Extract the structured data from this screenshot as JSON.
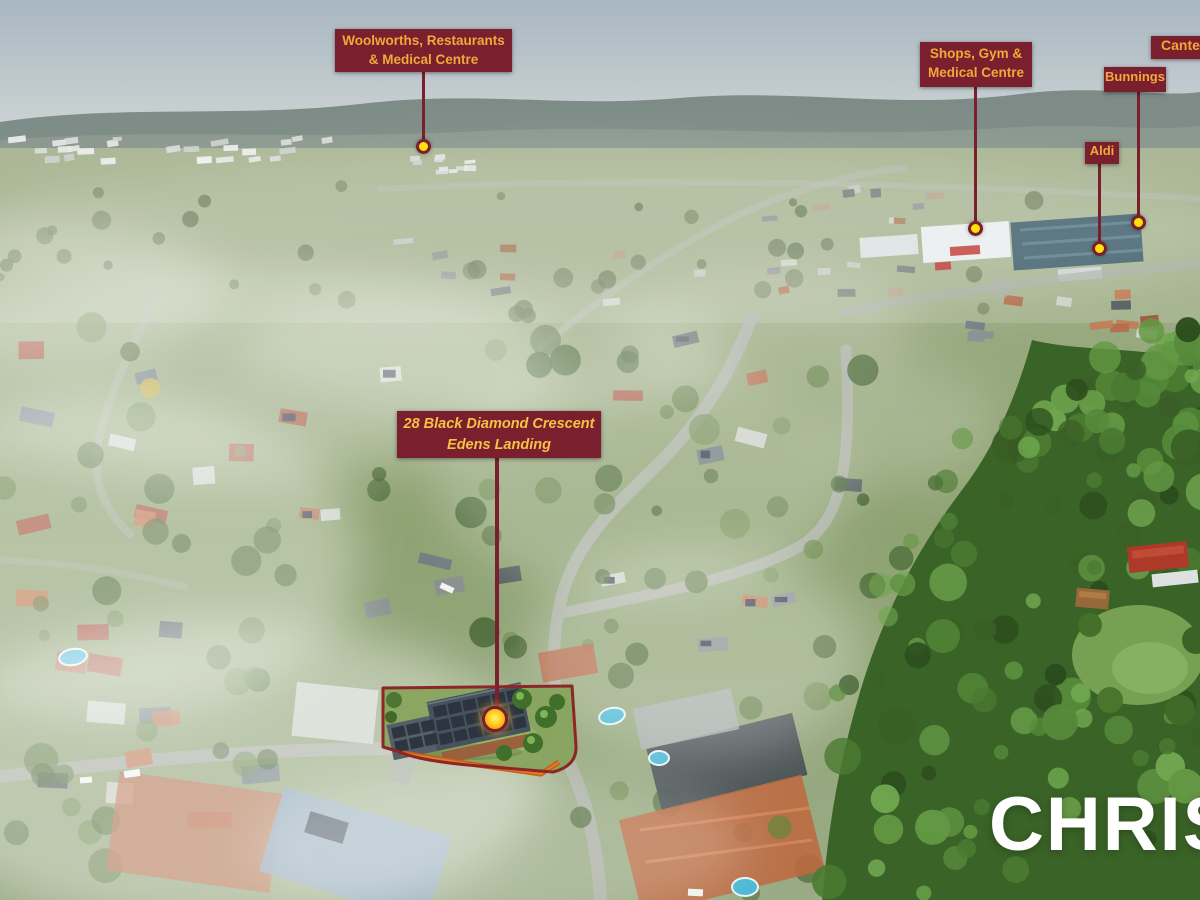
{
  "scene": {
    "description": "Aerial drone photograph of a suburb with amenity call-out labels for a property listing",
    "watermark": "CHRIS",
    "colors": {
      "label_background": "#7a1f2d",
      "label_text": "#f2a83a",
      "property_label_text": "#f6c145",
      "marker_fill": "#ffe10a",
      "marker_ring": "#7a1f2d",
      "property_outline": "#8d2626",
      "watermark_color": "#ffffff"
    }
  },
  "annotations": {
    "woolworths": {
      "line1": "Woolworths, Restaurants",
      "line2": "& Medical Centre"
    },
    "shops_gym": {
      "line1": "Shops, Gym &",
      "line2": "Medical Centre"
    },
    "canterbury": {
      "line1": "Canter"
    },
    "bunnings": {
      "line1": "Bunnings"
    },
    "aldi": {
      "line1": "Aldi"
    },
    "property": {
      "line1": "28 Black Diamond Crescent",
      "line2": "Edens Landing"
    }
  }
}
